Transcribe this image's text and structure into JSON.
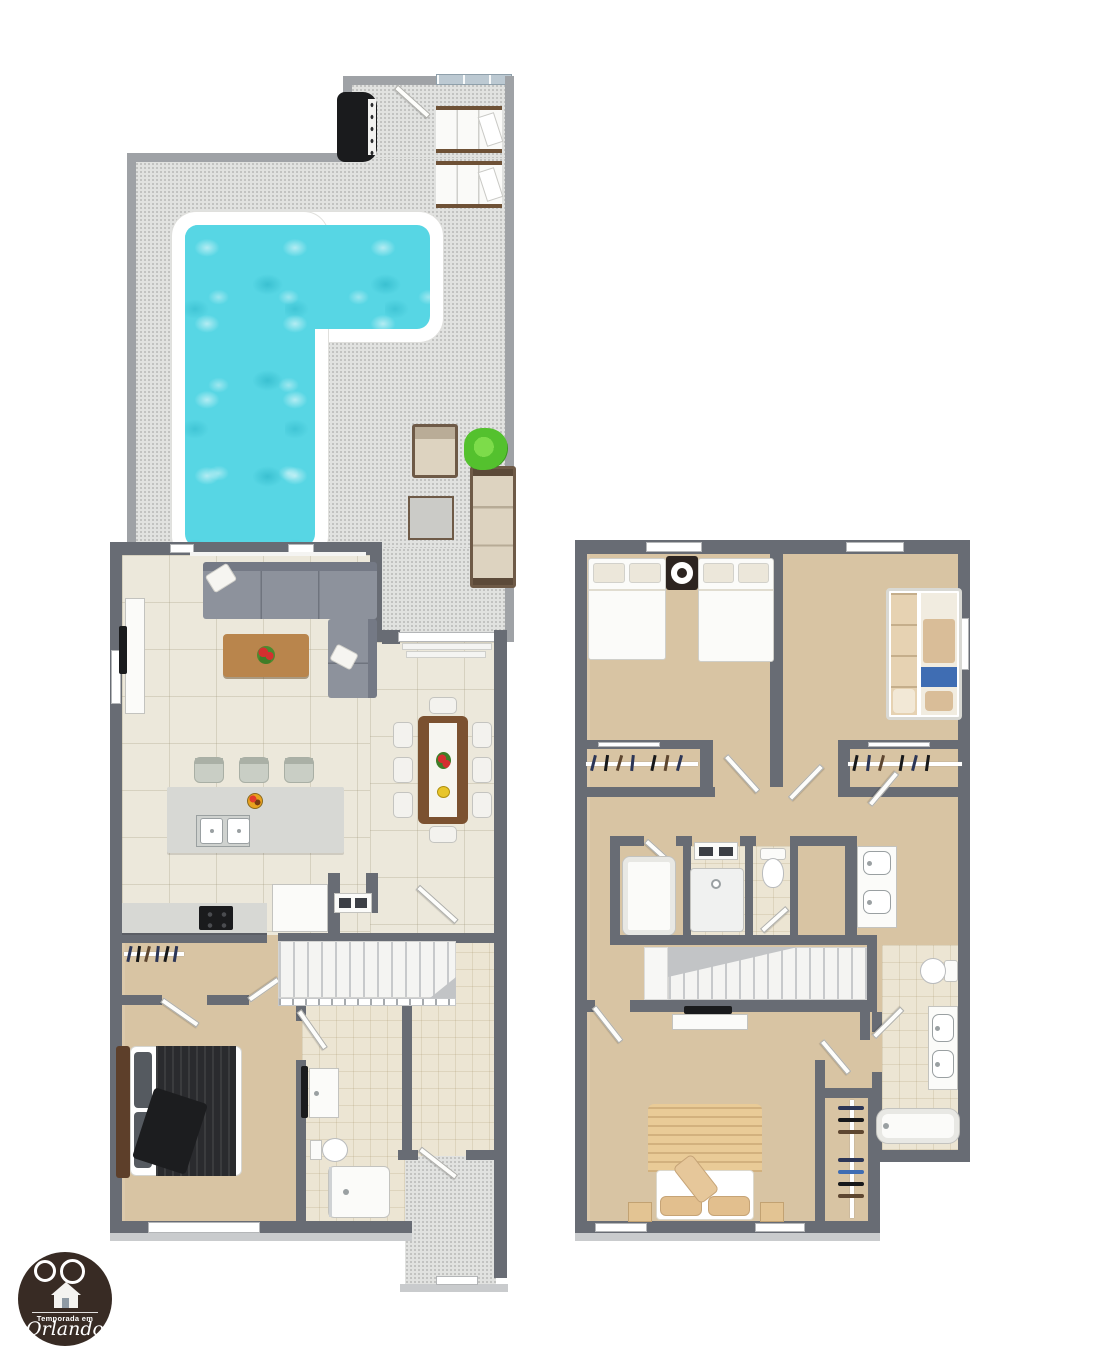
{
  "meta": {
    "description": "3D two-story vacation home floor plan with pool deck"
  },
  "logo": {
    "line1": "Temporada em",
    "line2": "Orlando"
  },
  "palette": {
    "wall": "#686c74",
    "wallmid": "#9fa2a6",
    "deck": "#e1e2e0",
    "pool": "#57d6e4",
    "cream": "#ece8db",
    "tan": "#d8c4a3",
    "bath": "#ece5d3",
    "sofa": "#8d929c",
    "sofadark": "#747985",
    "wood": "#b9854c",
    "wooddark": "#7b5130",
    "black": "#1a1b1d",
    "white": "#fbfbf9",
    "plant": "#54c12e",
    "bedtan": "#e9cb97",
    "glass": "#bcc9d2",
    "logobg": "#382b24"
  },
  "floor1": {
    "label": "First floor",
    "rooms": [
      "pool deck",
      "living room",
      "kitchen",
      "dining room",
      "bedroom",
      "bathroom",
      "entry porch"
    ],
    "furniture": [
      "l-shaped pool",
      "bbq grill",
      "sun loungers",
      "outdoor sofa set",
      "potted plant",
      "sectional sofa",
      "wall tv",
      "coffee table",
      "kitchen island with double sink",
      "bar stools",
      "cooktop",
      "refrigerator",
      "dining table for eight",
      "staircase",
      "closet",
      "double bed",
      "vanity",
      "toilet",
      "shower"
    ]
  },
  "floor2": {
    "label": "Second floor",
    "rooms": [
      "bedroom 2",
      "bedroom 3",
      "hallway",
      "bathroom 2",
      "water closet",
      "shared bathroom",
      "master bedroom",
      "master bathroom",
      "walk-in closet"
    ],
    "furniture": [
      "two double beds",
      "nightstand fan",
      "bunk bed",
      "reach-in closets",
      "washer dryer",
      "shower",
      "toilets",
      "double vanity",
      "staircase",
      "tv console",
      "king bed",
      "nightstands",
      "bathtub",
      "vanity"
    ]
  }
}
